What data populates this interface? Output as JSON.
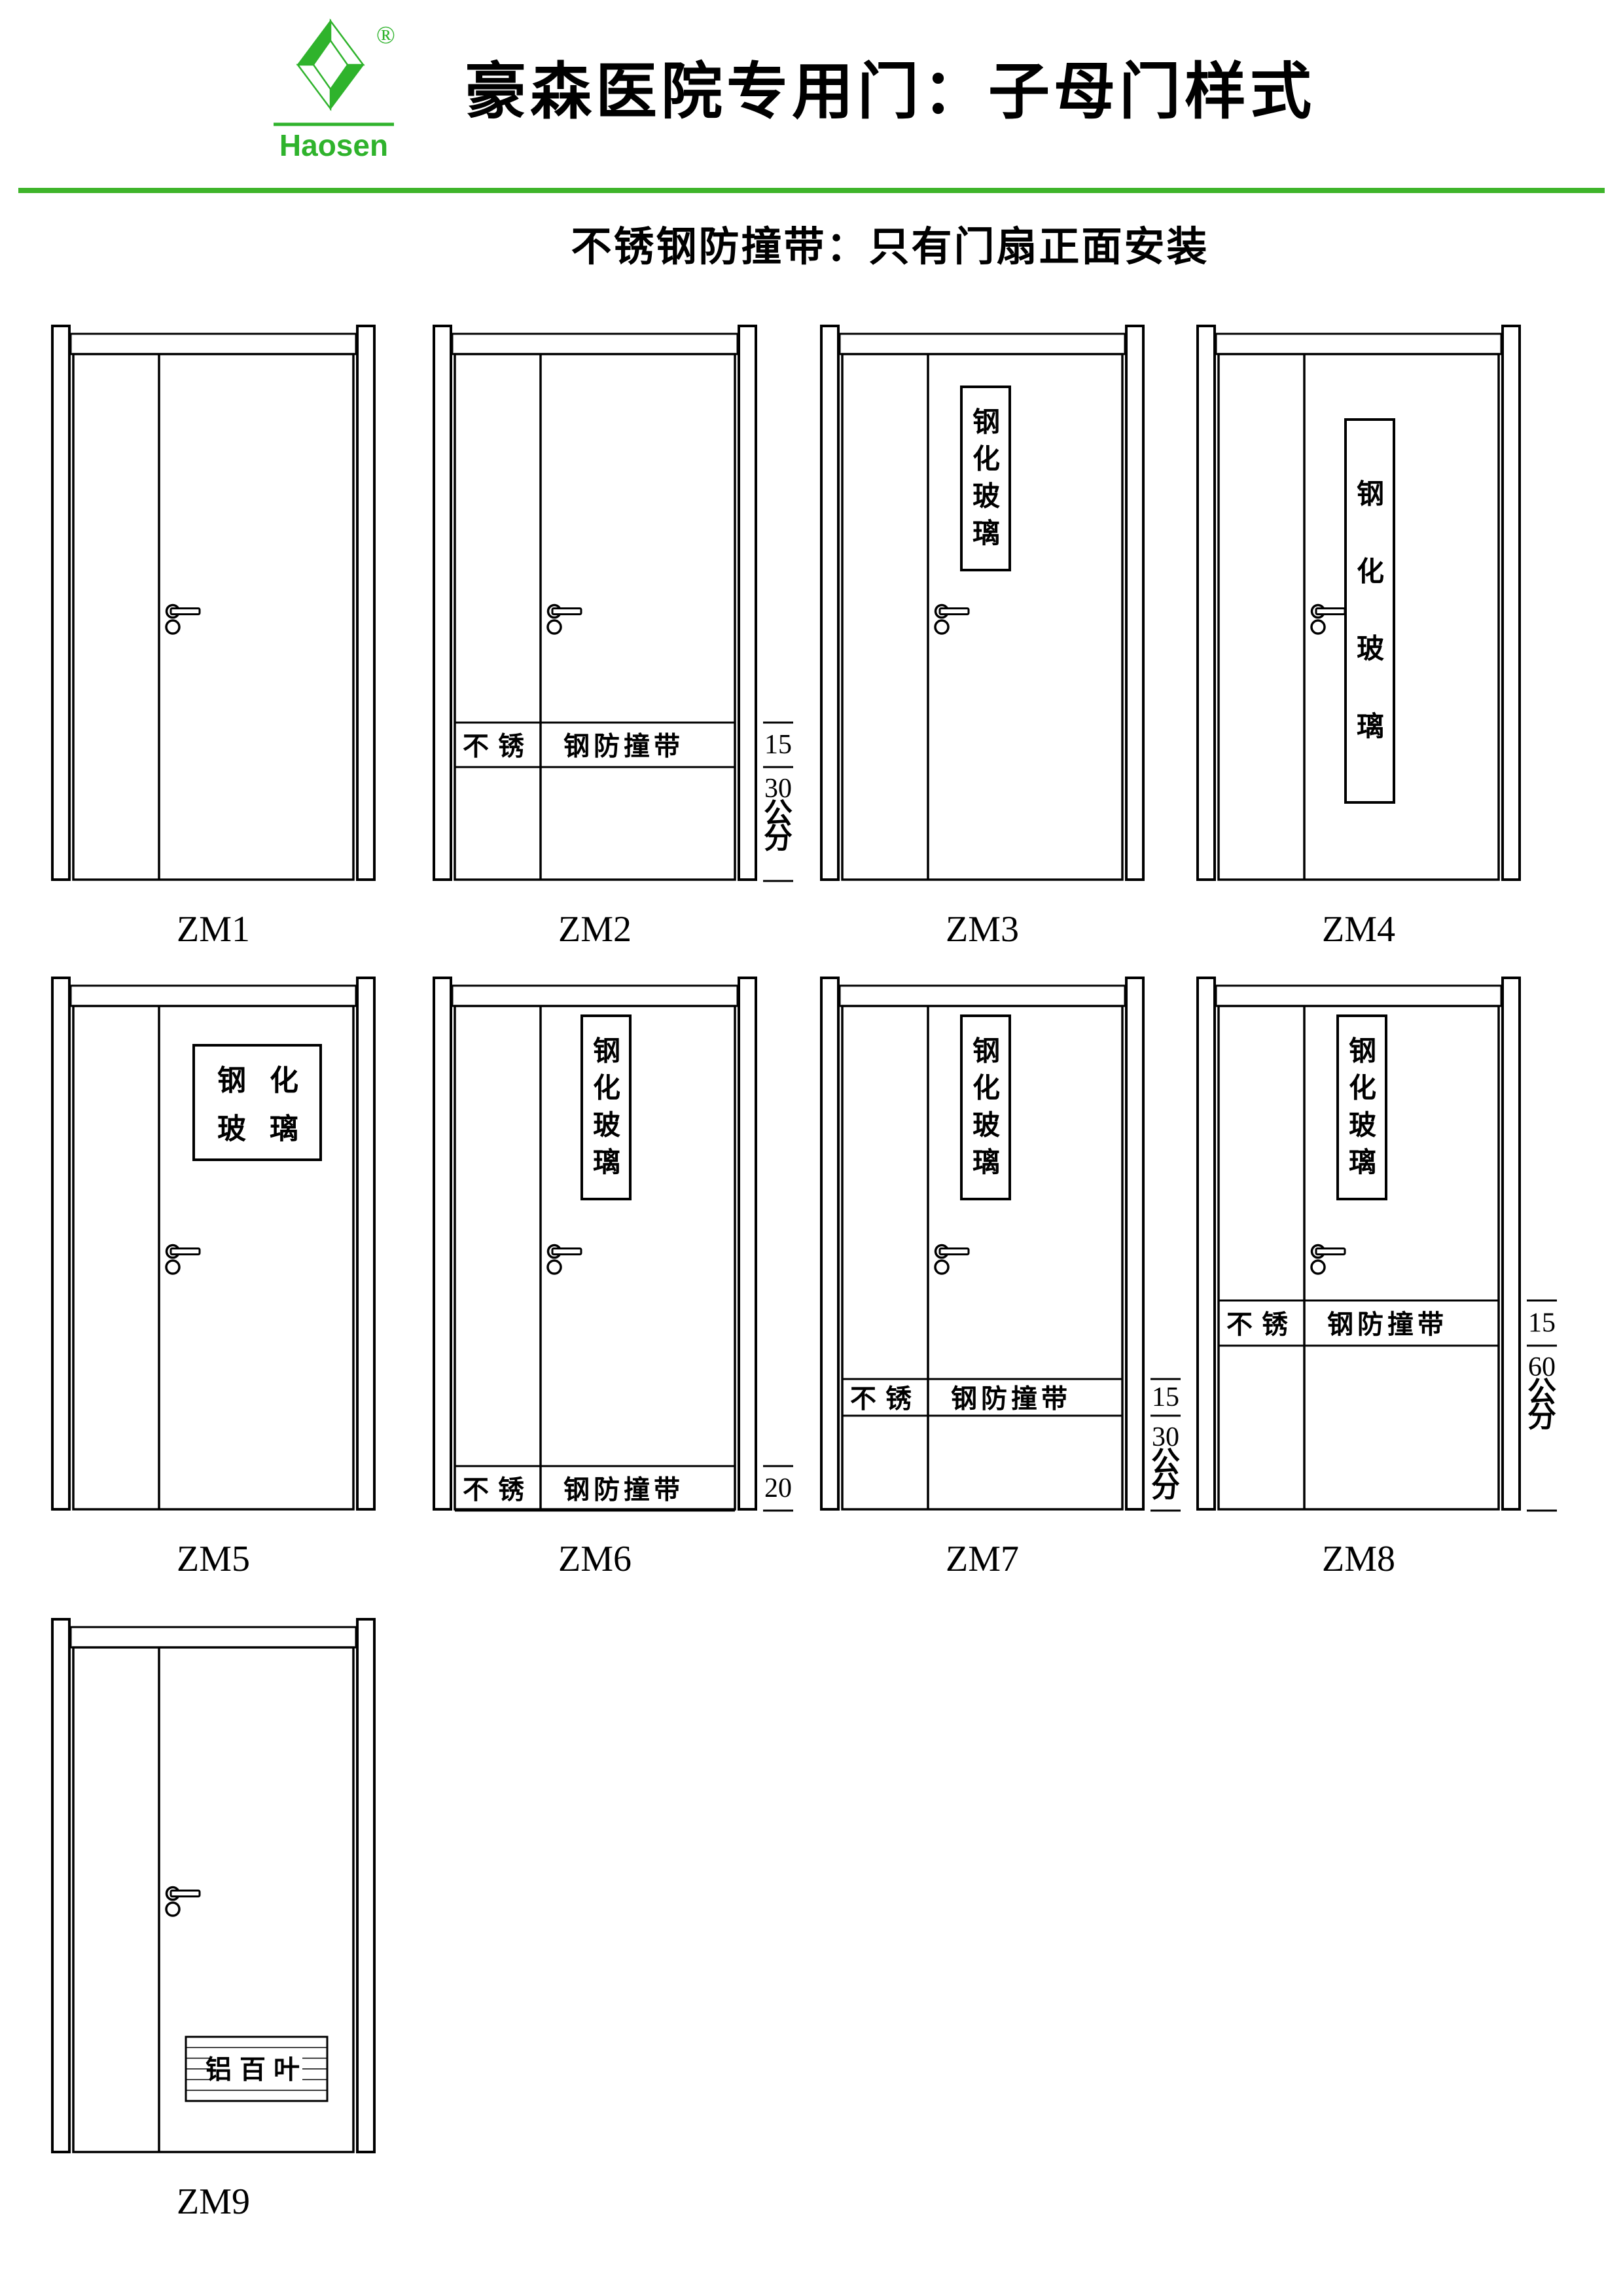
{
  "theme": {
    "accent_green": "#3eb42a",
    "logo_green": "#2fb32c",
    "line_black": "#000000"
  },
  "header": {
    "logo": {
      "brand": "Haosen",
      "registered_mark": "®"
    },
    "title": "豪森医院专用门：子母门样式",
    "subtitle": "不锈钢防撞带：只有门扇正面安装"
  },
  "strings": {
    "band_left": "不锈",
    "band_right": "钢防撞带",
    "glass_text": "钢化玻璃",
    "louver_text": "铝百叶"
  },
  "doors": [
    {
      "label": "ZM1"
    },
    {
      "label": "ZM2",
      "band": {
        "left": "不锈",
        "right": "钢防撞带"
      },
      "dims": {
        "upper": "15",
        "lower_value": "30",
        "lower_unit": "公分"
      }
    },
    {
      "label": "ZM3",
      "glass": {
        "chars": [
          "钢",
          "化",
          "玻",
          "璃"
        ]
      }
    },
    {
      "label": "ZM4",
      "glass": {
        "chars": [
          "钢",
          "化",
          "玻",
          "璃"
        ]
      }
    },
    {
      "label": "ZM5",
      "glass": {
        "chars": [
          "钢",
          "化",
          "玻",
          "璃"
        ]
      }
    },
    {
      "label": "ZM6",
      "glass": {
        "chars": [
          "钢",
          "化",
          "玻",
          "璃"
        ]
      },
      "band": {
        "left": "不锈",
        "right": "钢防撞带"
      },
      "dims": {
        "upper": "20"
      }
    },
    {
      "label": "ZM7",
      "glass": {
        "chars": [
          "钢",
          "化",
          "玻",
          "璃"
        ]
      },
      "band": {
        "left": "不锈",
        "right": "钢防撞带"
      },
      "dims": {
        "upper": "15",
        "lower_value": "30",
        "lower_unit": "公分"
      }
    },
    {
      "label": "ZM8",
      "glass": {
        "chars": [
          "钢",
          "化",
          "玻",
          "璃"
        ]
      },
      "band": {
        "left": "不锈",
        "right": "钢防撞带"
      },
      "dims": {
        "upper": "15",
        "lower_value": "60",
        "lower_unit": "公分"
      }
    },
    {
      "label": "ZM9",
      "louver": {
        "text": "铝百叶"
      }
    }
  ]
}
